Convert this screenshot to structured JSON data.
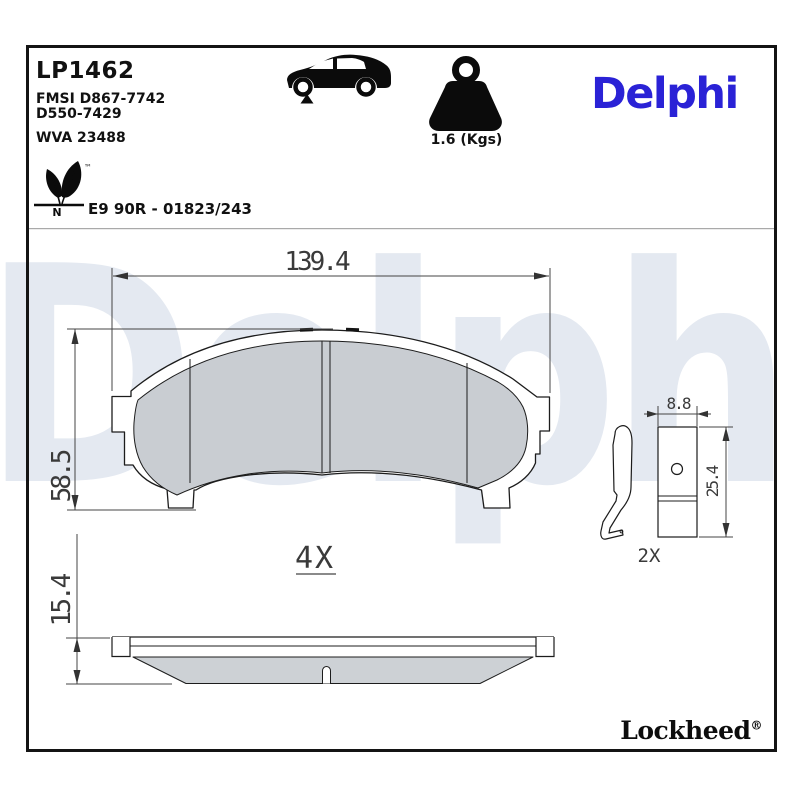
{
  "header": {
    "part_number": "LP1462",
    "fmsi_line1": "FMSI D867-7742",
    "fmsi_line2": "D550-7429",
    "wva_number": "WVA 23488",
    "homologation": "E9 90R - 01823/243",
    "eco_mark_letter": "N",
    "trademark_symbol": "™",
    "weight_value": "1.6 (Kgs)",
    "brand_logo": "Delphi"
  },
  "dimensions": {
    "pad_width_mm": "139.4",
    "pad_height_mm": "58.5",
    "pad_thickness_mm": "15.4",
    "pad_quantity": "4X",
    "accessory_width_mm": "8.8",
    "accessory_height_mm": "25.4",
    "accessory_quantity": "2X"
  },
  "footer": {
    "brand": "Lockheed",
    "registered_symbol": "®"
  },
  "watermark_text": "Delphi",
  "colors": {
    "brand_blue": "#2a22d6",
    "watermark_blue": "#e4e9f1",
    "friction_gray": "#c9cdd2",
    "line_dark": "#1c1c1c",
    "dimension_gray": "#3a3a3a"
  }
}
